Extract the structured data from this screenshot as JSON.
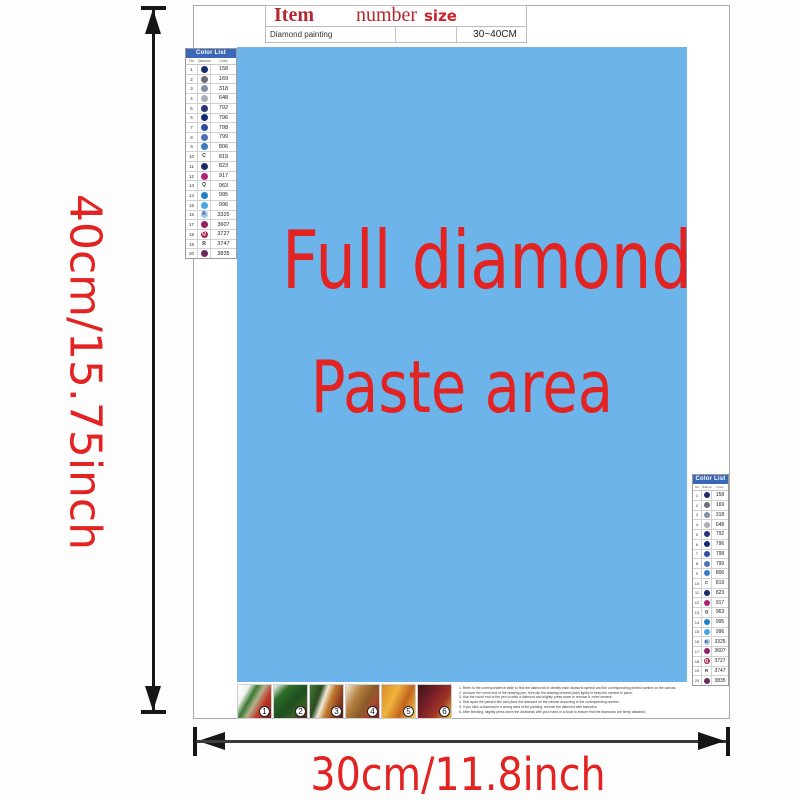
{
  "item_table": {
    "headers": [
      "Item",
      "number",
      "size"
    ],
    "row": {
      "item": "Diamond painting",
      "number": "",
      "size": "30~40CM"
    }
  },
  "paste_area": {
    "line1": "Full diamonds",
    "line2": "Paste area",
    "bg_color": "#6cb4e9",
    "text_color": "#e32222"
  },
  "dimensions": {
    "height_label": "40cm/15.75inch",
    "width_label": "30cm/11.8inch",
    "label_color": "#e32222"
  },
  "color_list": {
    "title": "Color List",
    "columns": [
      "No.",
      "Diamond",
      "Color"
    ],
    "rows": [
      {
        "no": "1",
        "sym_label": "",
        "sym_bg": "#1c2a6b",
        "sym_fg": "#ffffff",
        "code": "158"
      },
      {
        "no": "2",
        "sym_label": "",
        "sym_bg": "#6a6e76",
        "sym_fg": "#ffffff",
        "code": "169"
      },
      {
        "no": "3",
        "sym_label": "",
        "sym_bg": "#838da6",
        "sym_fg": "#ffffff",
        "code": "318"
      },
      {
        "no": "4",
        "sym_label": "",
        "sym_bg": "#aab0b8",
        "sym_fg": "#ffffff",
        "code": "648"
      },
      {
        "no": "5",
        "sym_label": "",
        "sym_bg": "#28337a",
        "sym_fg": "#ffffff",
        "code": "792"
      },
      {
        "no": "6",
        "sym_label": "",
        "sym_bg": "#152a74",
        "sym_fg": "#ffffff",
        "code": "796"
      },
      {
        "no": "7",
        "sym_label": "",
        "sym_bg": "#2d4da0",
        "sym_fg": "#ffffff",
        "code": "798"
      },
      {
        "no": "8",
        "sym_label": "",
        "sym_bg": "#4e6fba",
        "sym_fg": "#ffffff",
        "code": "799"
      },
      {
        "no": "9",
        "sym_label": "",
        "sym_bg": "#3a7ac2",
        "sym_fg": "#ffffff",
        "code": "806"
      },
      {
        "no": "10",
        "sym_label": "C",
        "sym_bg": "transparent",
        "sym_fg": "#333333",
        "code": "819"
      },
      {
        "no": "11",
        "sym_label": "",
        "sym_bg": "#1c2a66",
        "sym_fg": "#ffffff",
        "code": "823"
      },
      {
        "no": "12",
        "sym_label": "",
        "sym_bg": "#b02278",
        "sym_fg": "#ffffff",
        "code": "917"
      },
      {
        "no": "13",
        "sym_label": "Q",
        "sym_bg": "transparent",
        "sym_fg": "#333333",
        "code": "963"
      },
      {
        "no": "14",
        "sym_label": "",
        "sym_bg": "#1f80c4",
        "sym_fg": "#ffffff",
        "code": "995"
      },
      {
        "no": "15",
        "sym_label": "",
        "sym_bg": "#4aa6de",
        "sym_fg": "#ffffff",
        "code": "996"
      },
      {
        "no": "16",
        "sym_label": "K",
        "sym_bg": "#a6c6e6",
        "sym_fg": "#244a80",
        "code": "3325"
      },
      {
        "no": "17",
        "sym_label": "",
        "sym_bg": "#8e2162",
        "sym_fg": "#ffffff",
        "code": "3607"
      },
      {
        "no": "18",
        "sym_label": "Q",
        "sym_bg": "#a62748",
        "sym_fg": "#ffffff",
        "code": "3727"
      },
      {
        "no": "19",
        "sym_label": "R",
        "sym_bg": "transparent",
        "sym_fg": "#333333",
        "code": "3747"
      },
      {
        "no": "20",
        "sym_label": "",
        "sym_bg": "#6b2a5c",
        "sym_fg": "#ffffff",
        "code": "3835"
      }
    ]
  },
  "steps": [
    {
      "n": "1",
      "bg": "linear-gradient(120deg, #ffffff 0%, #f2f2ee 22%, #3a7a30 38%, #b5b08e 52%, #c03a2a 70%, #7a1f1f 100%)"
    },
    {
      "n": "2",
      "bg": "linear-gradient(135deg, #ffffff 0%, #2e6e2a 25%, #1d4d1d 55%, #3a5e22 75%, #5e1f28 100%)"
    },
    {
      "n": "3",
      "bg": "linear-gradient(110deg, #3f7a33 0%, #2a4a20 28%, #f0ead8 42%, #c27a2e 58%, #8a3a20 80%, #5e1f1f 100%)"
    },
    {
      "n": "4",
      "bg": "linear-gradient(120deg, #f2ead8 0%, #b5803f 32%, #8a5a28 58%, #a84a2e 75%, #6e1f2a 100%)"
    },
    {
      "n": "5",
      "bg": "linear-gradient(115deg, #d98a2b 0%, #f0b43c 35%, #c2641f 65%, #f2d24a 100%)"
    },
    {
      "n": "6",
      "bg": "linear-gradient(125deg, #3a1518 0%, #7a1f28 40%, #a33524 68%, #e8c23f 100%)"
    }
  ],
  "instructions": {
    "lines": [
      "1. Refer to the correspondence table to find the diamonds to identify each diamond symbol and the corresponding printed number on the canvas.",
      "2. Uncover the round end of the drawing pen, then dip the drawing cement (wax) lightly to keep the cement in place.",
      "3. Use the round end of the pen to stick a diamond and slightly press down to remove it, more cement.",
      "4. Tear apart the painted film and place the diamond on the canvas according to the corresponding number.",
      "5. If you stick a diamond in a wrong area of the painting, remove the diamond with tweezers.",
      "6. After finishing, slightly press down the diamonds with your hand or a book to ensure that the diamonds are firmly attached."
    ]
  }
}
